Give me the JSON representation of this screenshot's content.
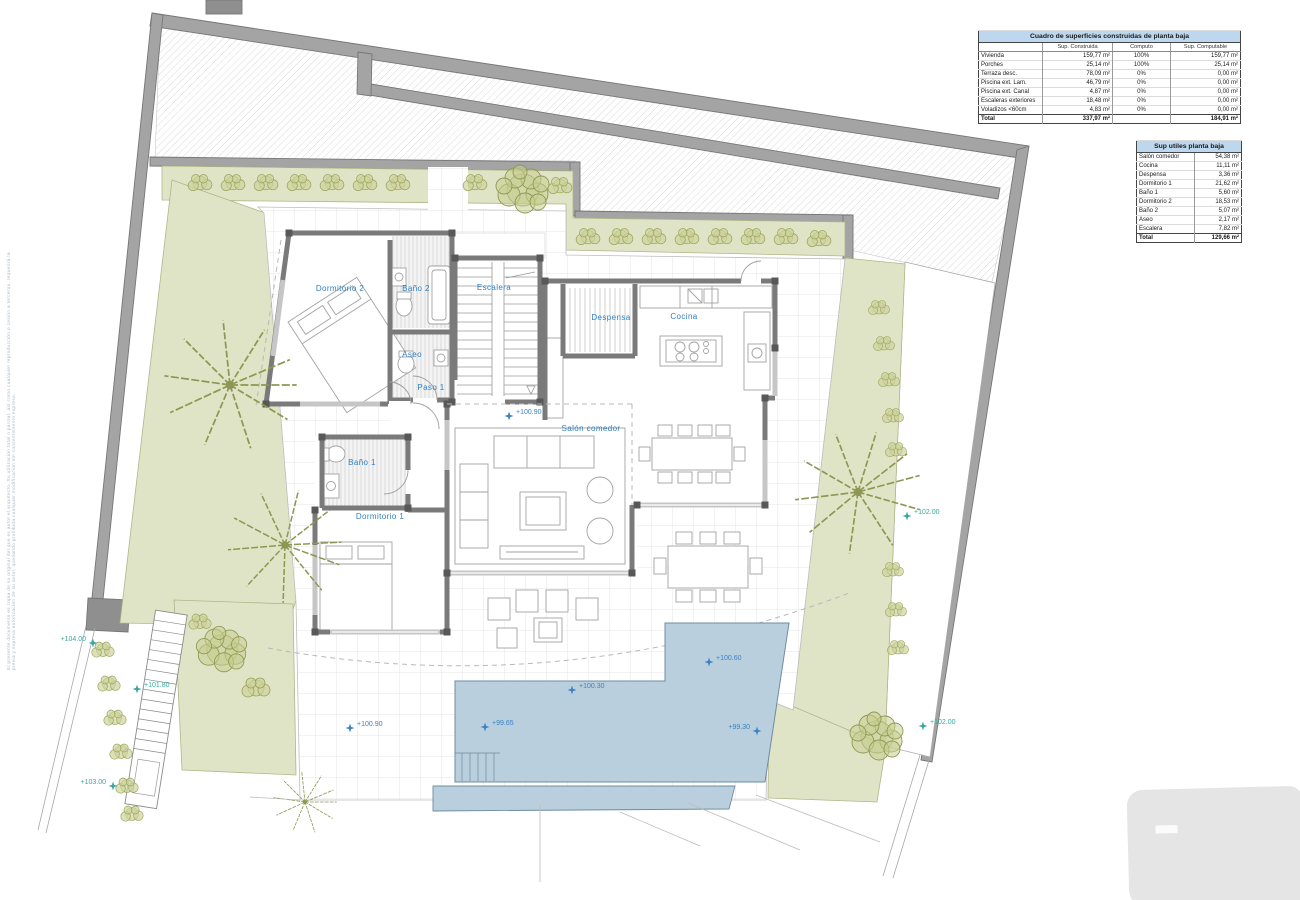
{
  "plan": {
    "rooms": {
      "dormitorio2": "Dormitorio 2",
      "bano2": "Baño 2",
      "escalera": "Escalera",
      "aseo": "Aseo",
      "paso1": "Paso 1",
      "despensa": "Despensa",
      "cocina": "Cocina",
      "salon": "Salón comedor",
      "bano1": "Baño 1",
      "dormitorio1": "Dormitorio 1"
    },
    "markers": {
      "salon": "+100.90",
      "terrace": "+100.90",
      "pool_high": "+100.60",
      "pool_mid": "+100.30",
      "pool_low": "+99.65",
      "pool_end": "+99.30",
      "site_top": "+104.00",
      "site_bottom": "+103.00",
      "site_stairs": "+101.80",
      "site_right_upper": "+102.00",
      "site_right_lower": "+102.00"
    }
  },
  "tables": {
    "built": {
      "title": "Cuadro de superficies construidas de planta baja",
      "col_label": "",
      "col1": "Sup. Construida",
      "col2": "Computo",
      "col3": "Sup. Computable",
      "rows": [
        {
          "label": "Vivienda",
          "built": "159,77 m²",
          "pct": "100%",
          "comp": "159,77 m²"
        },
        {
          "label": "Porches",
          "built": "25,14 m²",
          "pct": "100%",
          "comp": "25,14 m²"
        },
        {
          "label": "Terraza desc.",
          "built": "78,09 m²",
          "pct": "0%",
          "comp": "0,00 m²"
        },
        {
          "label": "Piscina ext. Lam.",
          "built": "46,79 m²",
          "pct": "0%",
          "comp": "0,00 m²"
        },
        {
          "label": "Piscina ext. Canal",
          "built": "4,87 m²",
          "pct": "0%",
          "comp": "0,00 m²"
        },
        {
          "label": "Escaleras exteriores",
          "built": "18,48 m²",
          "pct": "0%",
          "comp": "0,00 m²"
        },
        {
          "label": "Voladizos <60cm",
          "built": "4,83 m²",
          "pct": "0%",
          "comp": "0,00 m²"
        }
      ],
      "total": {
        "label": "Total",
        "built": "337,97 m²",
        "pct": "",
        "comp": "184,91 m²"
      }
    },
    "useful": {
      "title": "Sup utiles planta baja",
      "rows": [
        {
          "label": "Salón comedor",
          "value": "54,38 m²"
        },
        {
          "label": "Cocina",
          "value": "11,11 m²"
        },
        {
          "label": "Despensa",
          "value": "3,36 m²"
        },
        {
          "label": "Dormitorio 1",
          "value": "21,62 m²"
        },
        {
          "label": "Baño 1",
          "value": "5,60 m²"
        },
        {
          "label": "Dormitorio 2",
          "value": "18,53 m²"
        },
        {
          "label": "Baño 2",
          "value": "5,07 m²"
        },
        {
          "label": "Aseo",
          "value": "2,17 m²"
        },
        {
          "label": "Escalera",
          "value": "7,82 m²"
        }
      ],
      "total": {
        "label": "Total",
        "value": "129,66 m²"
      }
    }
  },
  "disclaimer": "El presente documento es copia de su original del que es autor el arquitecto. Su utilización total o parcial, así como cualquier reproducción o cesión a terceros, requerirá la previa y expresa autorización de su autor, quedando prohibida cualquier modificación sin consentimiento expreso.",
  "colors": {
    "wall": "#a4a4a4",
    "green": "#e0e4c6",
    "pool": "#b9cfdd",
    "label_blue": "#2e7fc2",
    "marker_teal": "#3aa79f",
    "table_header": "#bdd7ee"
  }
}
